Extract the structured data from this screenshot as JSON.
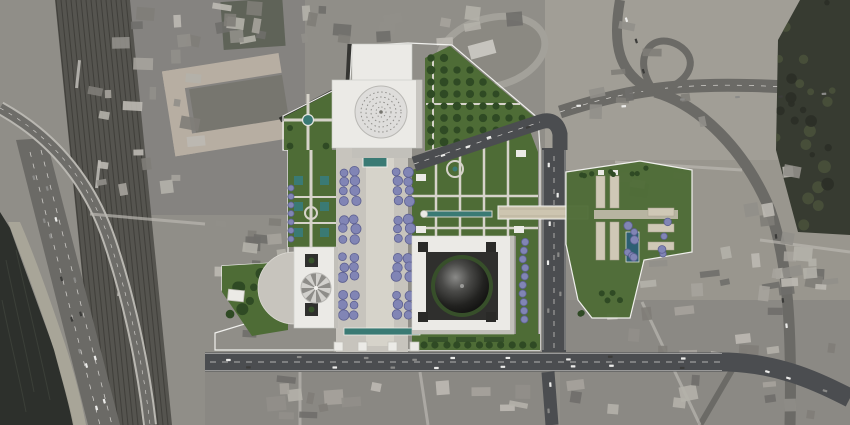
{
  "scene": {
    "kind": "aerial-masterplan-render",
    "description": "Color architectural site plan of a mosque complex superimposed on a grayscale satellite photo of a coastal urban district with railway yard, shoreline and highway interchange."
  },
  "palette": {
    "satellite_base": "#908e88",
    "satellite_light": "#a6a39b",
    "satellite_dark": "#7c7a75",
    "water": "#2d302c",
    "water_streak": "#474c43",
    "beach": "#aba79a",
    "rail_bed": "#55544f",
    "rail_line": "#3b3a36",
    "road_gray": "#6b6a66",
    "road_light": "#b9b7b1",
    "asphalt": "#4b4d50",
    "road_marking": "#eceae6",
    "forest": "#373b31",
    "forest_dark": "#2b2f27",
    "forest_light": "#49513b",
    "lawn": "#4e6c36",
    "lawn_dark": "#36512a",
    "tree_green": "#2f4a24",
    "tree_purple": "#8185b5",
    "tree_purple_dark": "#5e6192",
    "paving": "#bdb7a7",
    "paving_light": "#d6d3ca",
    "plaza": "#c7c4bd",
    "building_white": "#ebeae6",
    "building_shade": "#c2c0ba",
    "courtyard_dark": "#2f2f2d",
    "dome_gray": "#dedddb",
    "dome_stripe_light": "#d2d1cd",
    "dome_stripe_dark": "#8e8d89",
    "pool_teal": "#3a7a74",
    "pool_blue": "#2e5f73",
    "boundary_white": "#f5f5f2",
    "roof_tan": "#b7aea2",
    "bar_beige": "#cfc8b6",
    "bridge_beige": "#cdc5b0",
    "car_light": "#ececea",
    "car_dark": "#3c3c3a",
    "city_block_grays": [
      "#b4b1aa",
      "#a6a39c",
      "#7f7d78",
      "#918f89",
      "#6f6e6a",
      "#bcb9b2"
    ]
  },
  "landmarks": [
    {
      "id": "north-hall",
      "label": "north hall with lattice dome"
    },
    {
      "id": "central-esplanade",
      "label": "esplanade with jacaranda rows and reflecting pools"
    },
    {
      "id": "west-hall",
      "label": "west hall with ribbed dome and semicircular plaza"
    },
    {
      "id": "great-mosque",
      "label": "courtyard building with black dome"
    },
    {
      "id": "formal-garden",
      "label": "parterre garden with fountain and water channel"
    },
    {
      "id": "east-parcel",
      "label": "residential parcel with pool"
    },
    {
      "id": "pedestrian-bridge",
      "label": "bridge over ring road"
    },
    {
      "id": "railway-yard",
      "label": "railway yard"
    },
    {
      "id": "shoreline",
      "label": "sea shoreline"
    },
    {
      "id": "interchange",
      "label": "highway interchange"
    },
    {
      "id": "forest",
      "label": "wooded hillside"
    }
  ]
}
